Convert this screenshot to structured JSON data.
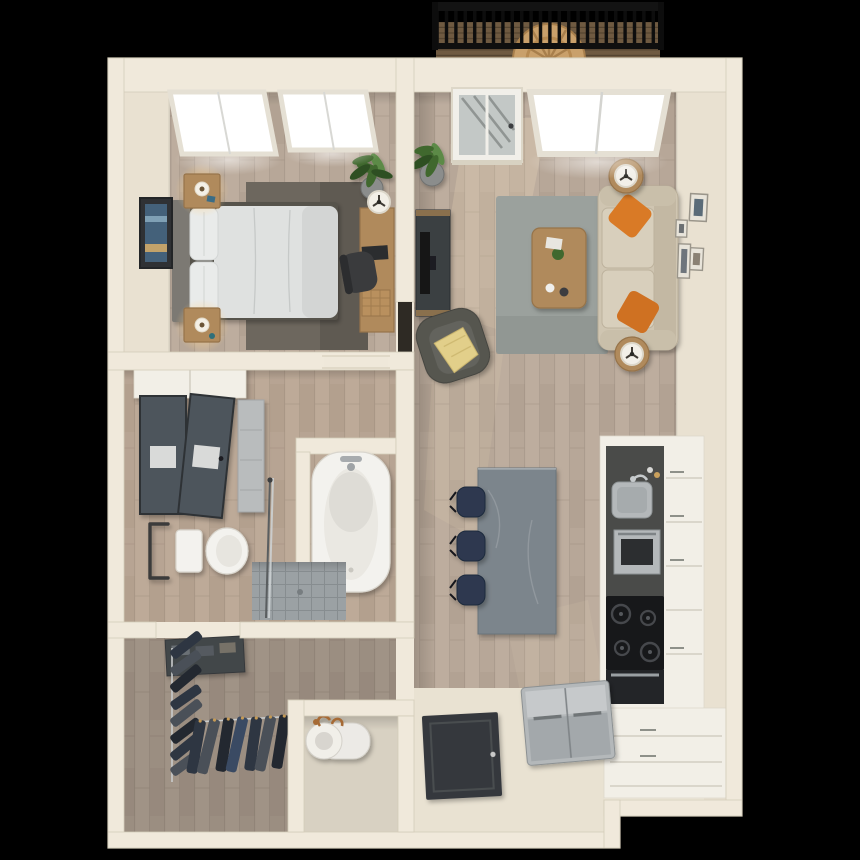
{
  "scene": {
    "type": "3d-floorplan-render",
    "description": "Top-down 3D dollhouse rendering of a one-bedroom apartment on a black background",
    "background": "#000000"
  },
  "palette": {
    "bg": "#000000",
    "wall": "#f0e9db",
    "wallFace": "#e9e1d1",
    "wallShade": "#d4ccb9",
    "woodA": "#b2a293",
    "woodB": "#bdad9e",
    "woodSeam": "#97897b",
    "entry": "#e9e2d2",
    "bedRug": "#6d675e",
    "livRug": "#9ba19d",
    "sofa": "#cfc5b1",
    "sofaSeat": "#d8cfbc",
    "orange": "#d97a28",
    "orangeDeep": "#cf7124",
    "armchair": "#565650",
    "throw": "#e2cf8a",
    "furnWood": "#b08a5c",
    "furnWoodDark": "#96734a",
    "island": "#7c858c",
    "stool": "#2d3950",
    "counter": "#4a4b49",
    "cooktop": "#17181a",
    "steel": "#b4b8ba",
    "steelDark": "#9aa0a3",
    "fixture": "#f3f2ee",
    "cabinet": "#f2efe7",
    "tile": "#9ba1a4",
    "tileLine": "#878d90",
    "mirror": "#4d545c",
    "clothA": "#2e3642",
    "clothB": "#4a5058",
    "clothC": "#232830",
    "copper": "#a66a36",
    "doorDark": "#35393c",
    "railing": "#131313",
    "balChair": "#c9a06b",
    "balFloor": "#6f5a41",
    "lampGlow": "#ffd289",
    "plant": "#41682f",
    "plantDark": "#2d4f21",
    "plantLight": "#5c8a46",
    "pot": "#8b8d8c",
    "art": "#44617a",
    "sun": "#ffedc8"
  },
  "rooms": [
    {
      "id": "balcony",
      "features": [
        "black metal railing",
        "wood deck",
        "round-back wooden chair"
      ]
    },
    {
      "id": "bedroom",
      "features": [
        "bed with white duvet",
        "gray headboard",
        "2 nightstands with lit lamps",
        "dark area rug",
        "wall art",
        "desk with chair and lamp",
        "potted plant",
        "2 bright windows"
      ]
    },
    {
      "id": "living-room",
      "features": [
        "beige sofa",
        "2 orange throw pillows",
        "2 round side tables with lamps",
        "wood coffee table",
        "gray area rug",
        "dark armchair with yellow throw",
        "tv console",
        "gallery wall of 4 frames",
        "large window",
        "balcony door",
        "potted plant",
        "sunlight patches"
      ]
    },
    {
      "id": "kitchen",
      "features": [
        "gray island",
        "3 navy bar stools",
        "charcoal countertop",
        "sink with faucet",
        "wall oven",
        "cooktop with 4 burners",
        "oven",
        "stainless refrigerator",
        "white cabinets"
      ]
    },
    {
      "id": "bathroom",
      "features": [
        "double vanity with dark mirrors",
        "toilet with grab bar",
        "soaking tub in alcove",
        "tiled shower with glass panel"
      ]
    },
    {
      "id": "walk-in-closet",
      "features": [
        "hanging clothes on two rods",
        "dark shelf unit"
      ]
    },
    {
      "id": "utility-closet",
      "features": [
        "water heater with copper pipes"
      ]
    },
    {
      "id": "entry",
      "features": [
        "dark front door",
        "cream tile floor"
      ]
    }
  ],
  "counts": {
    "bedroom_windows": 2,
    "living_room_windows": 1,
    "gallery_frames": 4,
    "bar_stools": 3,
    "cooktop_burners": 4,
    "orange_pillows": 2,
    "west_rod_garments": 8,
    "south_rod_garments": 7,
    "railing_balusters": 24
  }
}
